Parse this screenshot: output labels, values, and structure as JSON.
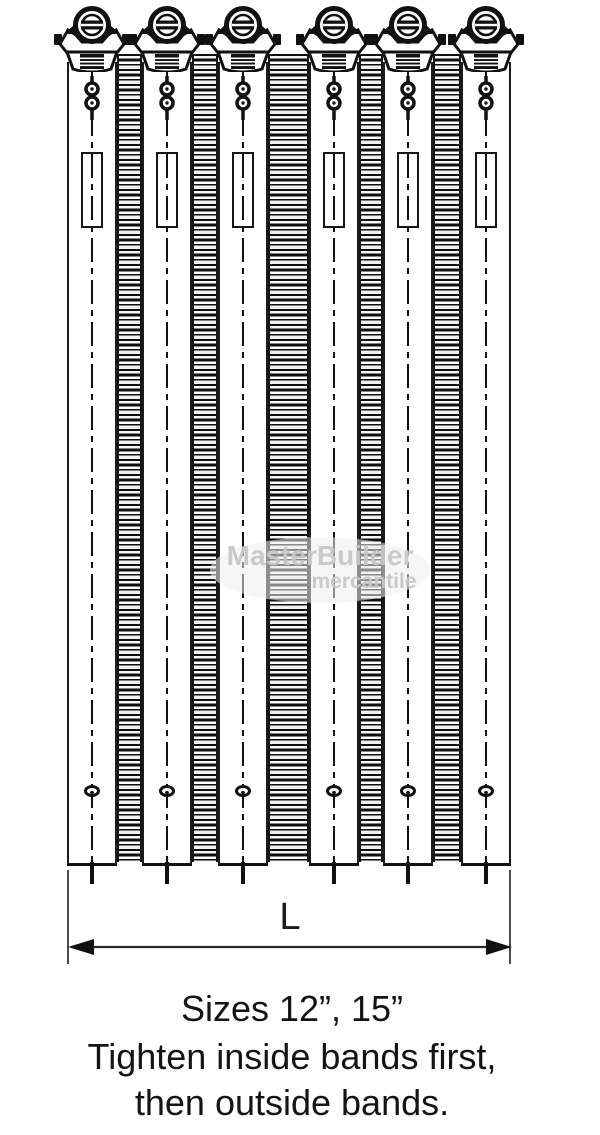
{
  "figure": {
    "bolt_count": 6,
    "band_count": 5
  },
  "dimension": {
    "label": "L"
  },
  "captions": {
    "sizes": "Sizes 12”, 15”",
    "instruction_line1": "Tighten inside bands first,",
    "instruction_line2": "then outside bands."
  },
  "watermark": {
    "name": "MasterBuilder",
    "subname": "mercantile"
  },
  "colors": {
    "ink": "#121212",
    "stripe_light": "#f5f5f5",
    "watermark_gray": "#c6c6c6",
    "dimension_line": "#2b2b2b",
    "background": "#ffffff"
  }
}
